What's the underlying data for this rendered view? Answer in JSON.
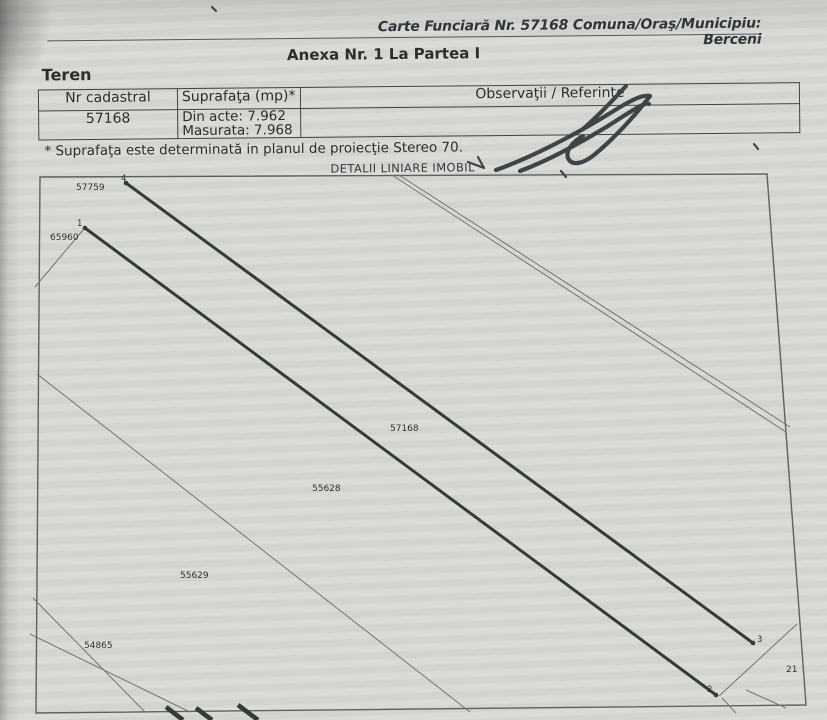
{
  "colors": {
    "paper": "#d8d9d5",
    "ink": "#2b2e2c",
    "rule": "#4e5a63",
    "thick_line": "#333b39",
    "thin_line": "#70746f",
    "frame": "#5c625e",
    "pen": "#3f4448"
  },
  "header": {
    "carte_funciara": "Carte Funciară Nr. 57168 Comuna/Oraş/Municipiu: Berceni",
    "anexa_title": "Anexa Nr. 1 La Partea I"
  },
  "section_title": "Teren",
  "table": {
    "columns": [
      "Nr cadastral",
      "Suprafaţa (mp)*",
      "Observaţii / Referinţe"
    ],
    "row": {
      "nr_cadastral": "57168",
      "suprafata_din_acte": "Din acte: 7.962",
      "suprafata_masurata": "Masurata: 7.968",
      "observatii": ""
    }
  },
  "footnote": "* Suprafaţa este determinată in planul de proiecţie Stereo 70.",
  "map": {
    "title": "DETALII LINIARE IMOBIL",
    "main_parcel": "57168",
    "labels": [
      {
        "text": "57759",
        "x": 76,
        "y": 190,
        "kind": "parcel"
      },
      {
        "text": "65960",
        "x": 50,
        "y": 240,
        "kind": "parcel"
      },
      {
        "text": "57168",
        "x": 390,
        "y": 431,
        "kind": "parcel"
      },
      {
        "text": "55628",
        "x": 312,
        "y": 491,
        "kind": "parcel"
      },
      {
        "text": "55629",
        "x": 180,
        "y": 578,
        "kind": "parcel"
      },
      {
        "text": "54865",
        "x": 84,
        "y": 648,
        "kind": "parcel"
      },
      {
        "text": "21",
        "x": 786,
        "y": 672,
        "kind": "parcel"
      },
      {
        "text": "4",
        "x": 121,
        "y": 181,
        "kind": "point"
      },
      {
        "text": "1",
        "x": 77,
        "y": 226,
        "kind": "point"
      },
      {
        "text": "3",
        "x": 757,
        "y": 642,
        "kind": "point"
      },
      {
        "text": "2",
        "x": 707,
        "y": 692,
        "kind": "point"
      }
    ]
  }
}
